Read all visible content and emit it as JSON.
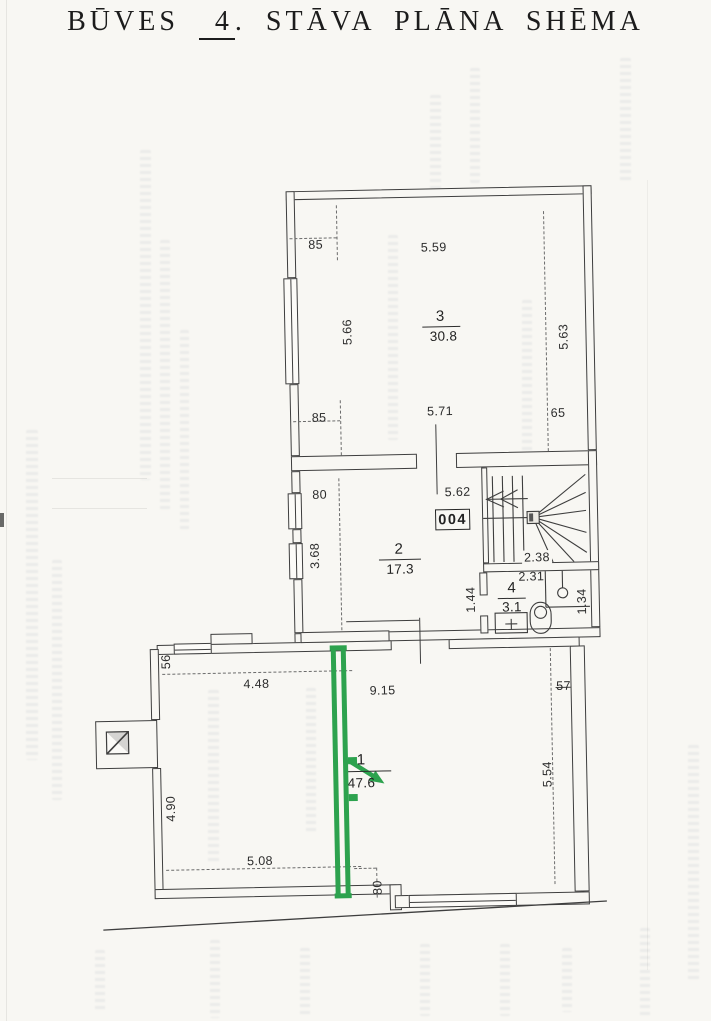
{
  "title": {
    "part1": "BŪVES",
    "floor_number": "4",
    "part2": ". STĀVA PLĀNA SHĒMA"
  },
  "door_plate": "004",
  "rooms": [
    {
      "number": "1",
      "area": "47.6"
    },
    {
      "number": "2",
      "area": "17.3"
    },
    {
      "number": "3",
      "area": "30.8"
    },
    {
      "number": "4",
      "area": "3.1"
    }
  ],
  "dims": {
    "r3_offset_top": "85",
    "r3_top": "5.59",
    "r3_left": "5.66",
    "r3_right": "5.63",
    "r3_bottom": "5.71",
    "r3_offset_bottom": "85",
    "r3_offset_br": "65",
    "r2_offset": "80",
    "r2_top": "5.62",
    "r2_left": "3.68",
    "stair_width": "2.38",
    "r4_top": "2.31",
    "r4_left": "1.44",
    "r4_right": "1.34",
    "r1_offset_tl": "56",
    "r1_top_left": "4.48",
    "r1_top": "9.15",
    "r1_offset_tr": "57",
    "r1_right": "5.54",
    "r1_left": "4.90",
    "r1_bottom": "5.08",
    "r1_offset_b": "80"
  },
  "colors": {
    "highlight_green": "#2da24e",
    "line": "#3e3e3e",
    "paper": "#f8f7f3"
  }
}
